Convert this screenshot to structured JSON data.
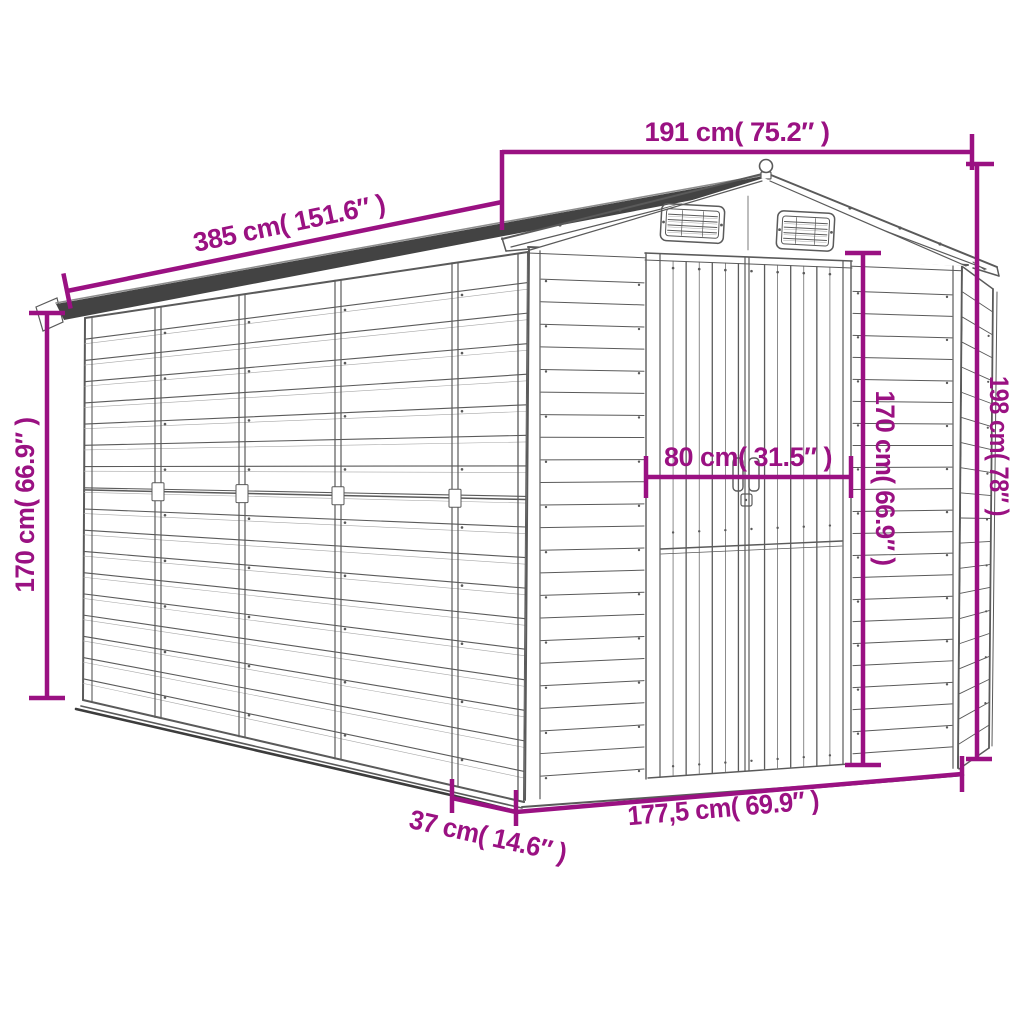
{
  "diagram": {
    "colors": {
      "dimension_accent": "#9a1182",
      "drawing_line": "#5a5a5a",
      "drawing_line_light": "#a8a8a8",
      "roof_fill": "#434343",
      "background": "#ffffff"
    },
    "dimensions": {
      "roof_width": {
        "label": "191 cm( 75.2″ )",
        "cm": "191",
        "inch": "75.2"
      },
      "roof_length": {
        "label": "385 cm( 151.6″ )",
        "cm": "385",
        "inch": "151.6"
      },
      "wall_height": {
        "label": "170 cm( 66.9″ )",
        "cm": "170",
        "inch": "66.9"
      },
      "door_width": {
        "label": "80 cm( 31.5″ )",
        "cm": "80",
        "inch": "31.5"
      },
      "door_height": {
        "label": "170 cm( 66.9″ )",
        "cm": "170",
        "inch": "66.9"
      },
      "overall_height": {
        "label": "198 cm( 78″ )",
        "cm": "198",
        "inch": "78"
      },
      "base_width": {
        "label": "177,5 cm( 69.9″ )",
        "cm": "177,5",
        "inch": "69.9"
      },
      "base_depth": {
        "label": "37 cm( 14.6″ )",
        "cm": "37",
        "inch": "14.6"
      }
    }
  }
}
